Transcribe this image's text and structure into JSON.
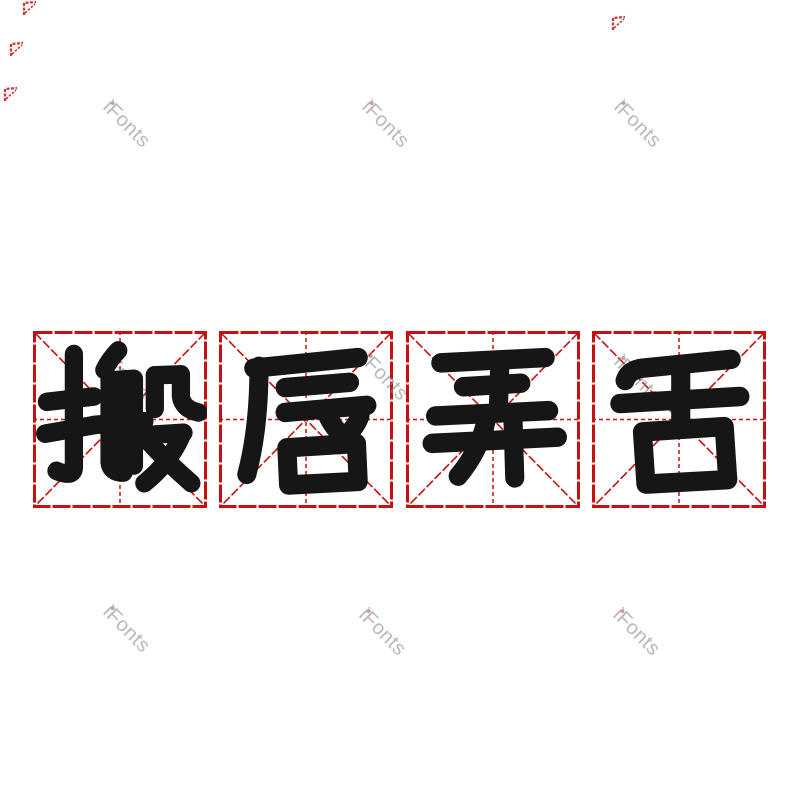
{
  "page": {
    "background": "#ffffff",
    "width": 800,
    "height": 800
  },
  "idiom": {
    "text": "搬唇弄舌",
    "glyph_color": "#161616",
    "characters": [
      {
        "char": "搬"
      },
      {
        "char": "唇"
      },
      {
        "char": "弄"
      },
      {
        "char": "舌"
      }
    ]
  },
  "grid": {
    "line_color": "#c5100f",
    "y": 331,
    "width": 174,
    "height": 177,
    "cells": [
      {
        "x": 33
      },
      {
        "x": 219
      },
      {
        "x": 406
      },
      {
        "x": 592
      }
    ]
  },
  "watermark": {
    "text": "iFonts",
    "color": "#8a8a8a",
    "dot_color": "#b05a52",
    "opacity": 0.6,
    "rotation_deg": 45,
    "positions": [
      {
        "x": 126,
        "y": 125
      },
      {
        "x": 385,
        "y": 125
      },
      {
        "x": 637,
        "y": 125
      },
      {
        "x": 126,
        "y": 378
      },
      {
        "x": 384,
        "y": 378
      },
      {
        "x": 637,
        "y": 380
      },
      {
        "x": 126,
        "y": 630
      },
      {
        "x": 382,
        "y": 633
      },
      {
        "x": 636,
        "y": 633
      }
    ]
  },
  "edge_fragments": {
    "color": "#c5100f",
    "positions": [
      {
        "x": 30,
        "y": 8
      },
      {
        "x": 619,
        "y": 23
      },
      {
        "x": 17,
        "y": 49
      },
      {
        "x": 11,
        "y": 94
      }
    ]
  }
}
